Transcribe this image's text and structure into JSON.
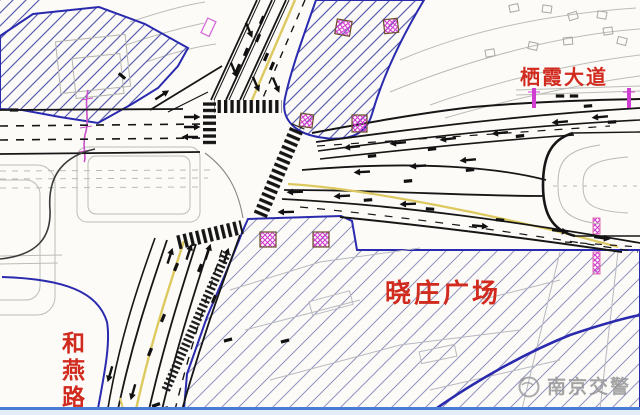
{
  "diagram": {
    "type": "intersection-traffic-organization-plan",
    "labels": {
      "road_northeast": "栖霞大道",
      "plaza": "晓庄广场",
      "road_southwest": "和燕路",
      "road_southwest_chars": [
        "和",
        "燕",
        "路"
      ]
    },
    "watermark": {
      "text": "南京交警"
    },
    "colors": {
      "label_red": "#d12a1e",
      "boundary_navy": "#2a2aae",
      "hatch_blue": "#5c60b0",
      "hatch_gray_blue": "#9094bd",
      "lane_yellow": "#ddc95f",
      "signal_magenta": "#cf3ed0",
      "road_black": "#161616",
      "faint_gray": "#b9b9b2",
      "watermark_gray": "#949496",
      "footer_blue": "#4a7bd6"
    }
  }
}
